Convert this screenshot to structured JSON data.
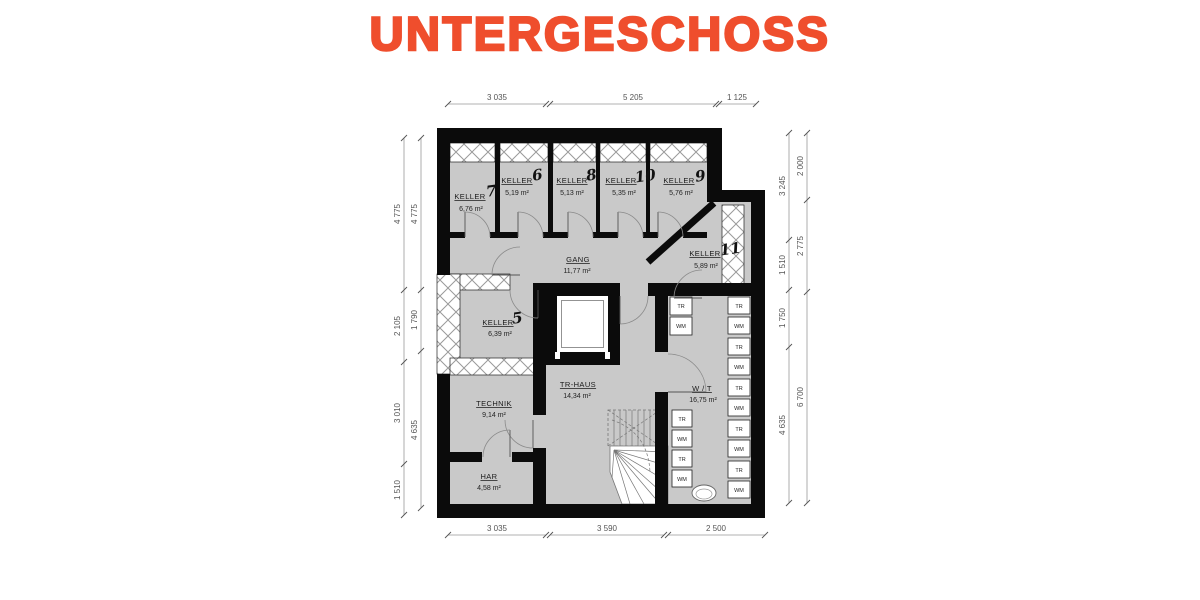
{
  "title": "UNTERGESCHOSS",
  "accent_color": "#EF4E2D",
  "rooms": {
    "keller7": {
      "name": "KELLER",
      "number": "7",
      "area": "6,76 m²"
    },
    "keller6": {
      "name": "KELLER",
      "number": "6",
      "area": "5,19 m²"
    },
    "keller8": {
      "name": "KELLER",
      "number": "8",
      "area": "5,13 m²"
    },
    "keller10": {
      "name": "KELLER",
      "number": "10",
      "area": "5,35 m²"
    },
    "keller9": {
      "name": "KELLER",
      "number": "9",
      "area": "5,76 m²"
    },
    "keller11": {
      "name": "KELLER",
      "number": "11",
      "area": "5,89 m²"
    },
    "keller5": {
      "name": "KELLER",
      "number": "5",
      "area": "6,39 m²"
    },
    "gang": {
      "name": "GANG",
      "area": "11,77 m²"
    },
    "technik": {
      "name": "TECHNIK",
      "area": "9,14 m²"
    },
    "trhaus": {
      "name": "TR-HAUS",
      "area": "14,34 m²"
    },
    "wt": {
      "name": "W / T",
      "area": "16,75 m²"
    },
    "har": {
      "name": "HAR",
      "area": "4,58 m²"
    }
  },
  "dimensions": {
    "top": [
      "3 035",
      "5 205",
      "1 125"
    ],
    "bottom": [
      "3 035",
      "3 590",
      "2 500"
    ],
    "left_outer": [
      "4 775",
      "2 105",
      "3 010",
      "1 510"
    ],
    "left_inner": [
      "4 775",
      "1 790",
      "4 635"
    ],
    "right_inner": [
      "3 245",
      "1 510",
      "1 750",
      "4 635"
    ],
    "right_outer": [
      "2 000",
      "2 775",
      "6 700"
    ]
  },
  "appliances": {
    "left_top": [
      "TR",
      "WM"
    ],
    "left_bottom": [
      "TR",
      "WM",
      "TR",
      "WM"
    ],
    "right": [
      "TR",
      "WM",
      "TR",
      "WM",
      "TR",
      "WM",
      "TR",
      "WM",
      "TR",
      "WM"
    ]
  }
}
